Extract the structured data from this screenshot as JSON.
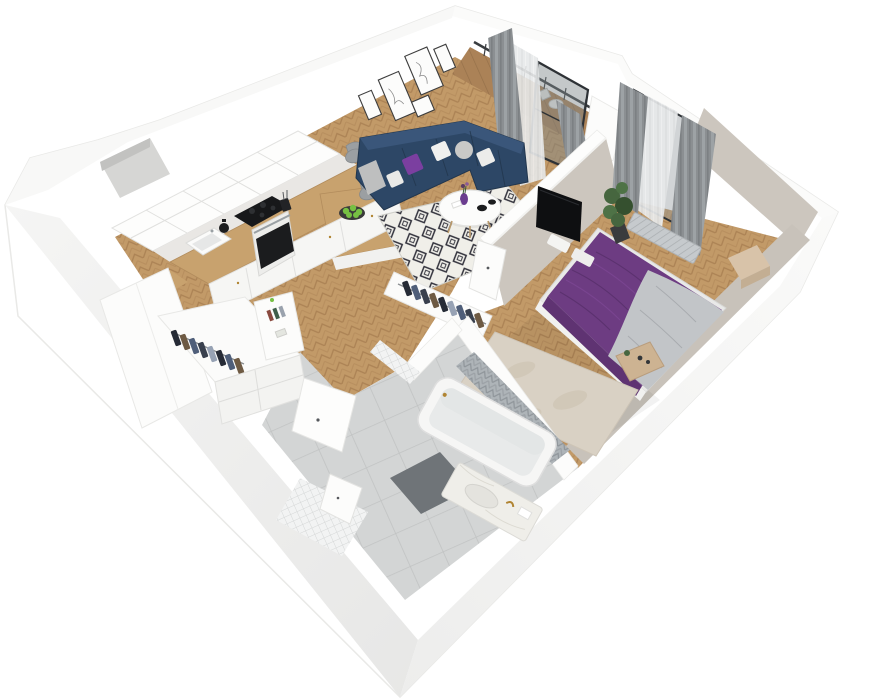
{
  "scene": {
    "type": "3d-floor-plan-render",
    "view": "isometric cutaway, rotated ~24 degrees, white background",
    "rooms": [
      {
        "name": "kitchen",
        "floor": "herringbone wood"
      },
      {
        "name": "living-room",
        "floor": "herringbone wood"
      },
      {
        "name": "balcony",
        "floor": "wood planks"
      },
      {
        "name": "bedroom",
        "floor": "herringbone wood"
      },
      {
        "name": "bathroom",
        "floor": "large gray tiles"
      },
      {
        "name": "hallway",
        "floor": "large gray tiles"
      }
    ],
    "furniture": {
      "kitchen": [
        "white shaker upper cabinets",
        "marble backsplash",
        "wooden L countertop with peninsula bar",
        "black cooktop",
        "oven with black glass door",
        "white sink",
        "black kettle",
        "utensil cup",
        "plate of green apples",
        "two gray bar chairs"
      ],
      "living_room": [
        "navy L-shaped sectional sofa",
        "purple pillow",
        "white pillows",
        "gray fluffy pillow",
        "black and white diamond rug",
        "round white coffee table",
        "purple vase with flowers",
        "black bowls",
        "gallery wall of five line-art frames"
      ],
      "balcony": [
        "glass door with dark frame",
        "railing",
        "white bistro table and chairs",
        "gray curtains",
        "sheer curtains"
      ],
      "bedroom": [
        "double bed with purple spread",
        "gray throw blanket",
        "white pillows",
        "cream textured rug",
        "wall-mounted black TV on partition",
        "potted plant",
        "radiator under window",
        "wooden nightstand",
        "beige side box",
        "open closet rack with dark clothes",
        "gray curtains",
        "sheer curtain",
        "greige accent walls"
      ],
      "bathroom": [
        "white bathtub",
        "chevron tiled wall",
        "mosaic tiled walls",
        "dark gray bath mat",
        "marble vanity with gold faucet",
        "white interior doors"
      ],
      "hallway": [
        "open wardrobe rack with clothes",
        "white drawer cabinets",
        "open shelf with books",
        "tall white cabinet",
        "white door"
      ]
    }
  },
  "palette": {
    "bg": "#ffffff",
    "wall_white": "#fdfdfc",
    "wall_edge": "#e9e9e7",
    "floor_wood": "#c29a68",
    "floor_wood_dark": "#a87f52",
    "balcony_wood": "#ab8257",
    "counter_wood": "#c8a26e",
    "tile_gray": "#d3d5d5",
    "tile_line": "#c1c3c3",
    "sofa_navy": "#2d4766",
    "sofa_navy_light": "#3a567a",
    "sofa_navy_dark": "#22364d",
    "pillow_purple": "#7b3fa0",
    "bed_purple": "#6d3c82",
    "bed_purple_dark": "#59306c",
    "bed_purple_light": "#7d4794",
    "blanket_gray": "#c2c5c8",
    "rug_cream": "#d9d1c4",
    "rug_living_bg": "#f0efe9",
    "rug_living_diamond": "#31313b",
    "curtain_gray": "#8b8f92",
    "sheer": "#e7e9ea",
    "greige": "#ccc6be",
    "greige_dark": "#c8c2ba",
    "tv_black": "#0e0f11",
    "plant_green": "#46663f",
    "plant_green_dark": "#35502f",
    "marble": "#efeee9",
    "gold": "#b08432",
    "chevron_gray": "#aeb4b8",
    "chevron_line": "#8f959a",
    "mat_dark": "#6f7478",
    "apple_green": "#76c043",
    "cloth_a": "#262b36",
    "cloth_b": "#4f5e79",
    "cloth_c": "#6e5a43",
    "cloth_d": "#39404e",
    "cloth_e": "#97a2b4",
    "book_red": "#8a4a3f",
    "book_green": "#3f5e4a",
    "book_gray": "#9aa2ad",
    "appliance_black": "#17181a",
    "door_frame_dark": "#2e3236"
  }
}
